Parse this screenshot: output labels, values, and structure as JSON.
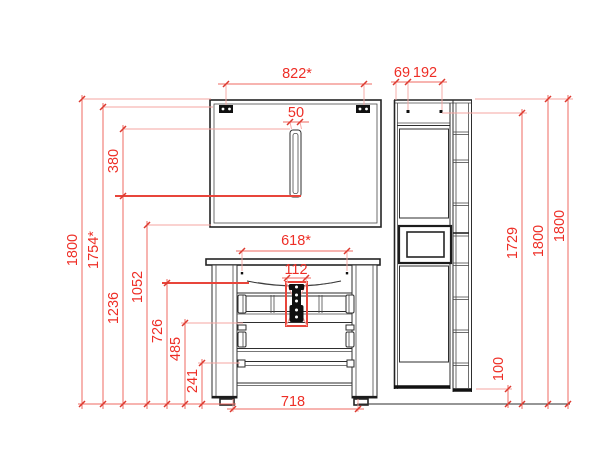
{
  "drawing": {
    "kind": "bathroom-furniture-elevation",
    "units": "mm"
  },
  "colors": {
    "background": "#ffffff",
    "line_dark": "#2e2e2e",
    "dimension_red": "#ee2e26",
    "extension_pink": "#f6a5a1"
  },
  "components": {
    "mirror_cabinet": "mirror cabinet",
    "vanity_cabinet": "vanity cabinet with basin and drawers",
    "tall_cabinet": "tall side cabinet with open niche and shelf column"
  },
  "dimensions": {
    "mirror_width": "822*",
    "mirror_handle_width": "50",
    "mirror_handle_height": "380",
    "tall_offset": "69",
    "tall_hardware_spacing": "192",
    "basin_fixing_width": "618*",
    "drain_width": "112",
    "vanity_width": "718",
    "overall_height_left": "1800",
    "mirror_top_height": "1754*",
    "handle_bottom_height": "1236",
    "mirror_bottom_height": "1052",
    "basin_rim_height": "726",
    "drawer_divider_height": "485",
    "bottom_rail_height": "241",
    "tall_floor_gap": "100",
    "tall_hardware_height": "1729",
    "tall_height_a": "1800",
    "tall_height_b": "1800"
  }
}
